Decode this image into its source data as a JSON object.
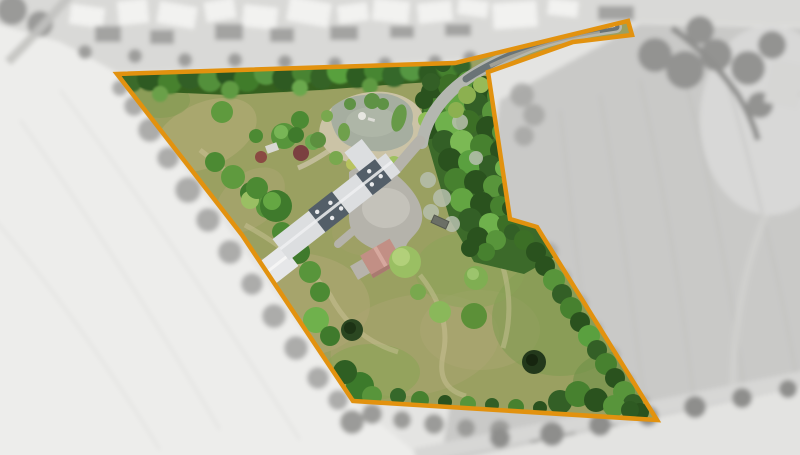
{
  "image": {
    "type": "aerial-drone-photograph",
    "width": 800,
    "height": 455,
    "description": "Overhead drone photo of a rural smallholding. The plot is outlined in orange; the interior is shown in full colour while all surrounding village houses and farm fields are desaturated to black-and-white and softly blurred.",
    "highlight_effect": "colour-inside-boundary, grayscale-blur-outside"
  },
  "boundary": {
    "points": "117,74 455,63 628,21 632,35 573,42 488,72 510,219 537,227 657,420 353,401 242,235",
    "color": "#E2920F",
    "stroke_width": 4.5
  },
  "palette": {
    "meadow": "#9aa061",
    "meadow_dry": "#b7ad7c",
    "hedge_dark": "#35601f",
    "forest": "#3c6a2a",
    "tree_light": "#7fae52",
    "pond_water": "#a6aea0",
    "pond_path": "#cbc3a6",
    "paving": "#b5b3ab",
    "lane": "#b4b7b0",
    "asphalt": "#5d686c",
    "roof_light": "#dcdee0",
    "roof_dark": "#535e68",
    "roof_red": "#c28f85",
    "barn_roof": "#e6e7e9",
    "field_light": "#ededeb",
    "field_mid": "#c9c9c7",
    "village_gray": "#d9d9d7",
    "shadow_gray": "#a5a5a3"
  },
  "features": [
    {
      "id": "farmhouse",
      "label": "Long farmhouse with alternating light and dark slate roof sections and skylights"
    },
    {
      "id": "barn",
      "label": "White-roofed barn wing at the south-west end of the house"
    },
    {
      "id": "red-roof-outbuilding",
      "label": "Small outbuilding with pink terracotta roof south of the courtyard"
    },
    {
      "id": "courtyard",
      "label": "Grey gravel courtyard and drive beside the house"
    },
    {
      "id": "pond",
      "label": "Ornamental pond with fountain, planted islands and gravel surround"
    },
    {
      "id": "access-lane",
      "label": "Narrow fenced access lane running north-east to the village road"
    },
    {
      "id": "conifer-wood",
      "label": "Dense conifer woodland along the eastern side"
    },
    {
      "id": "meadow",
      "label": "Large mown grass paddock with dry patches and specimen bushes"
    },
    {
      "id": "hedgerows",
      "label": "Mature hedgerows and trees along every boundary"
    },
    {
      "id": "village",
      "label": "Village rooftops along the top edge (desaturated)"
    },
    {
      "id": "fields",
      "label": "Ploughed farm fields and bottom road (desaturated)"
    }
  ]
}
